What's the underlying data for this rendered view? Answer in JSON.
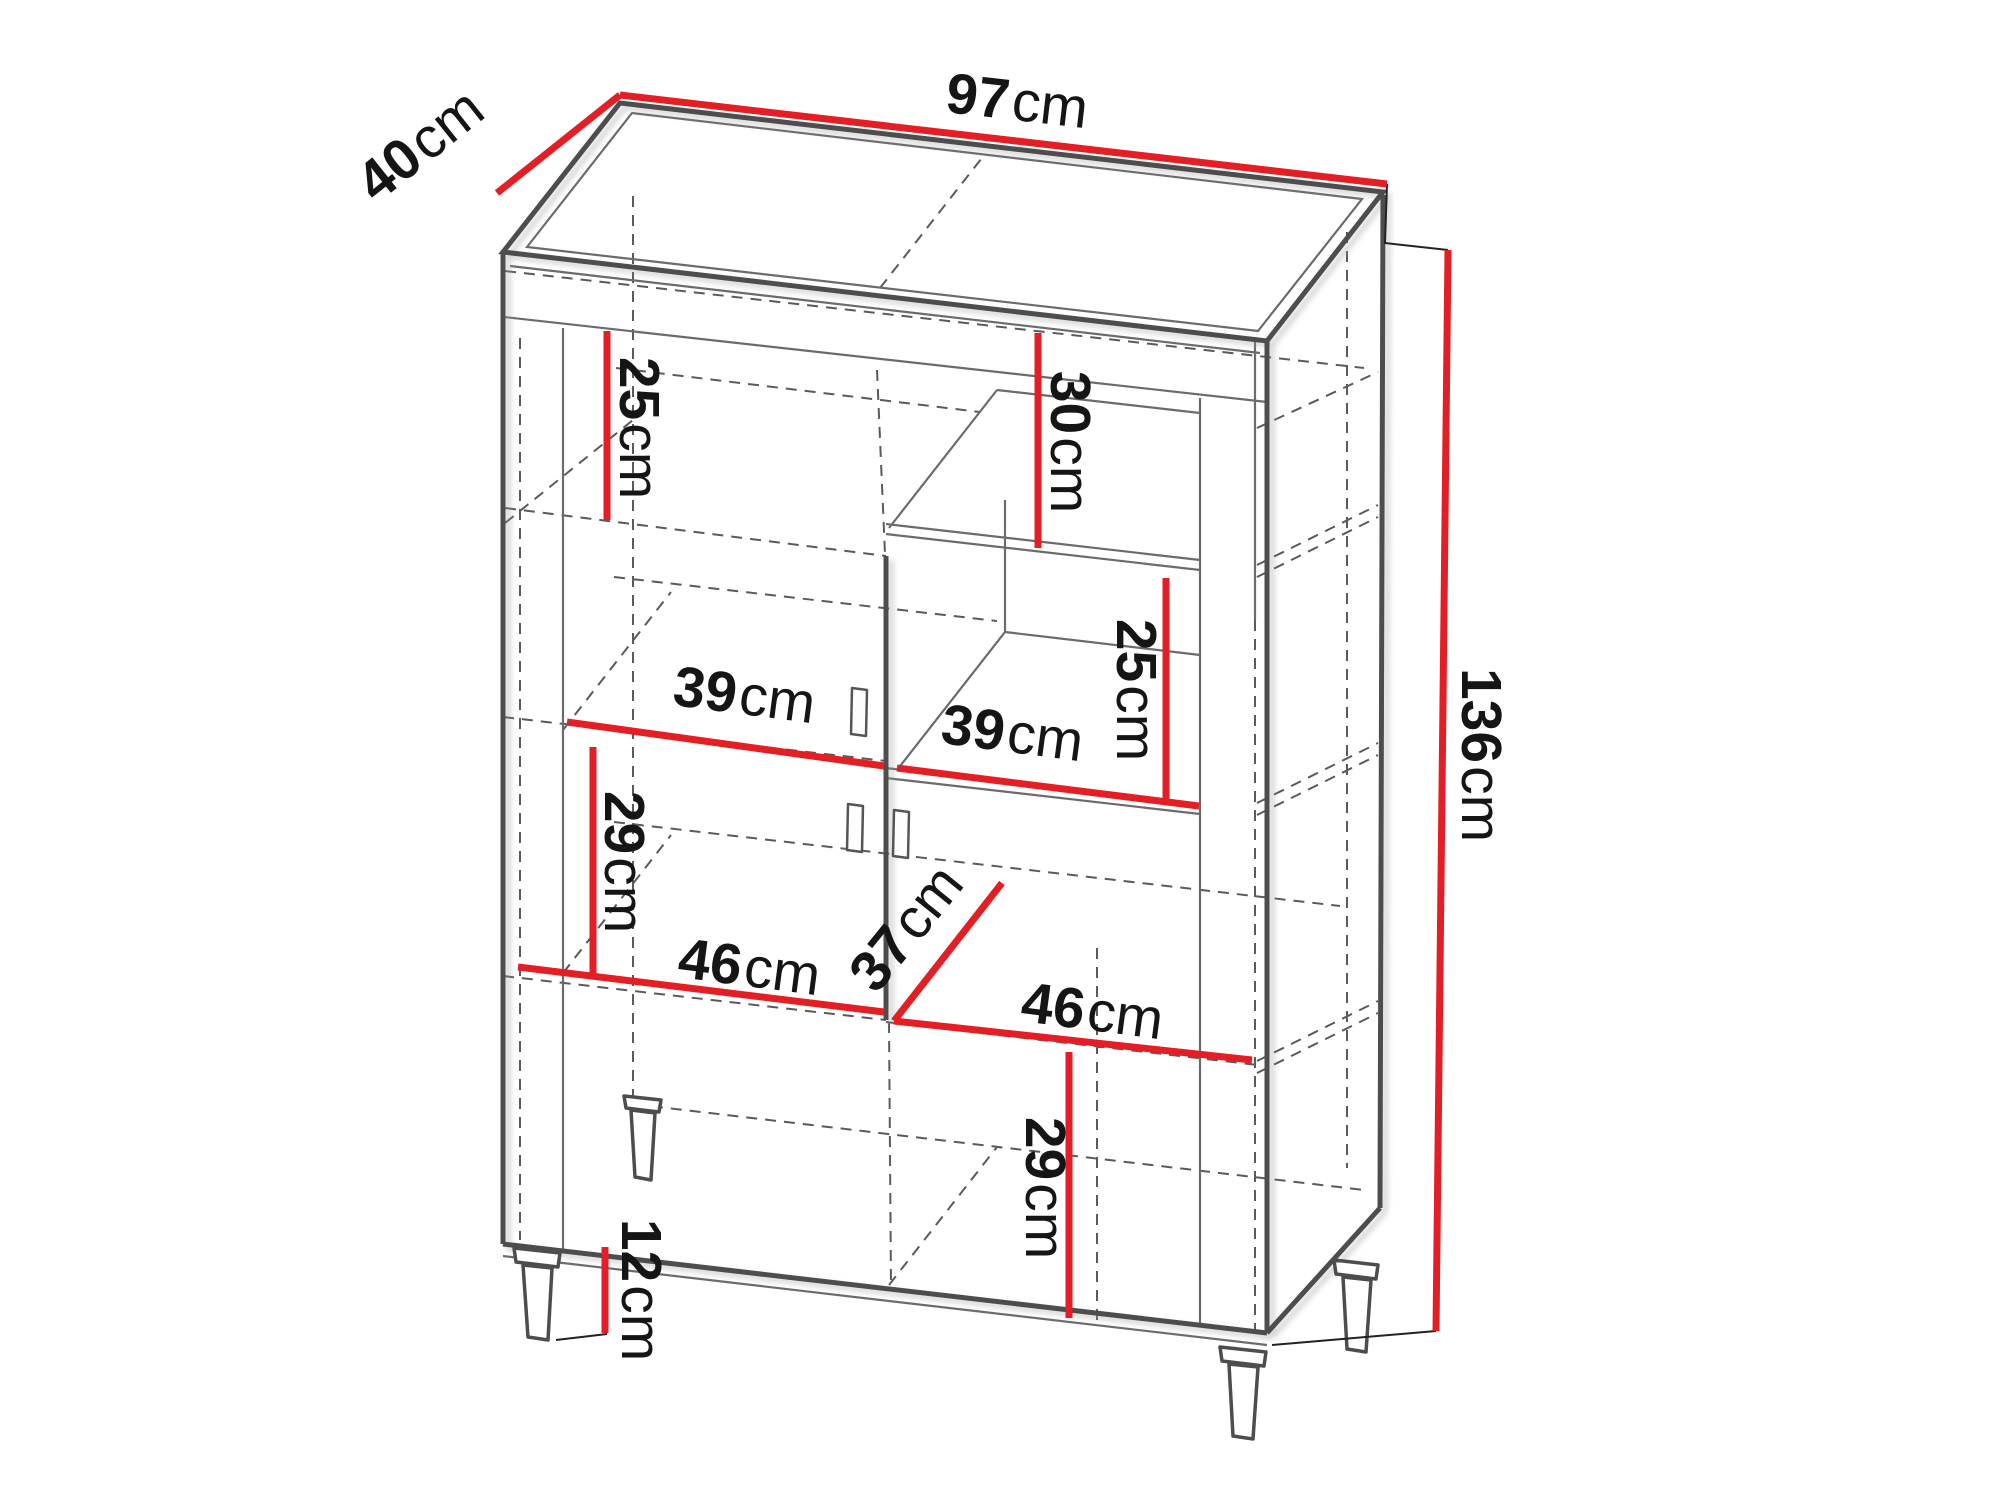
{
  "diagram": {
    "kind": "furniture-dimension-drawing",
    "product": "two-door display cabinet with legs",
    "unit_system": "cm",
    "accent_color": "#e31e24",
    "line_color": "#4d4d4d",
    "text_color": "#151515"
  },
  "dims": {
    "width": {
      "v": "97",
      "u": "cm"
    },
    "depth": {
      "v": "40",
      "u": "cm"
    },
    "height": {
      "v": "136",
      "u": "cm"
    },
    "top_left_shelf": {
      "v": "25",
      "u": "cm"
    },
    "top_right_niche": {
      "v": "30",
      "u": "cm"
    },
    "mid_right_niche": {
      "v": "25",
      "u": "cm"
    },
    "left_inner_width": {
      "v": "39",
      "u": "cm"
    },
    "right_inner_width": {
      "v": "39",
      "u": "cm"
    },
    "left_mid_height": {
      "v": "29",
      "u": "cm"
    },
    "left_bottom_width": {
      "v": "46",
      "u": "cm"
    },
    "inner_depth": {
      "v": "37",
      "u": "cm"
    },
    "right_bottom_width": {
      "v": "46",
      "u": "cm"
    },
    "right_bottom_height": {
      "v": "29",
      "u": "cm"
    },
    "leg_height": {
      "v": "12",
      "u": "cm"
    }
  }
}
